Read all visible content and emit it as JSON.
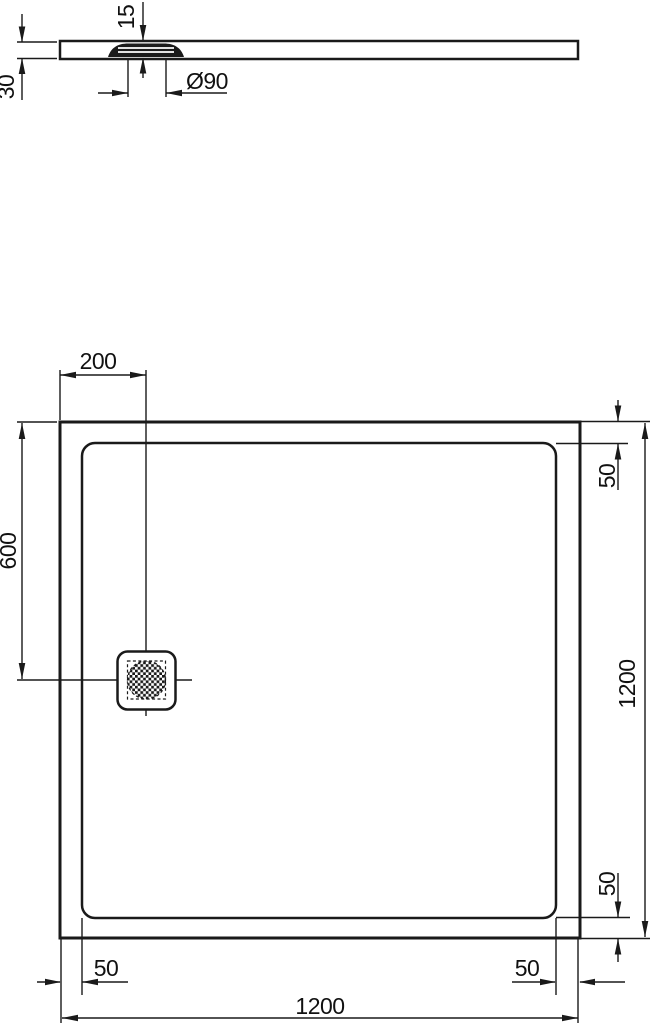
{
  "colors": {
    "line": "#1a1a1a",
    "background": "#ffffff"
  },
  "profile_view": {
    "tray_height_label": "30",
    "drain_recess_depth_label": "15",
    "drain_diameter_label": "Ø90"
  },
  "plan_view": {
    "drain_offset_horizontal_label": "200",
    "drain_offset_vertical_label": "600",
    "rim_top_right_label": "50",
    "rim_bottom_right_vertical_label": "50",
    "rim_bottom_left_horizontal_label": "50",
    "rim_bottom_right_horizontal_label": "50",
    "overall_height_label": "1200",
    "overall_width_label": "1200"
  }
}
